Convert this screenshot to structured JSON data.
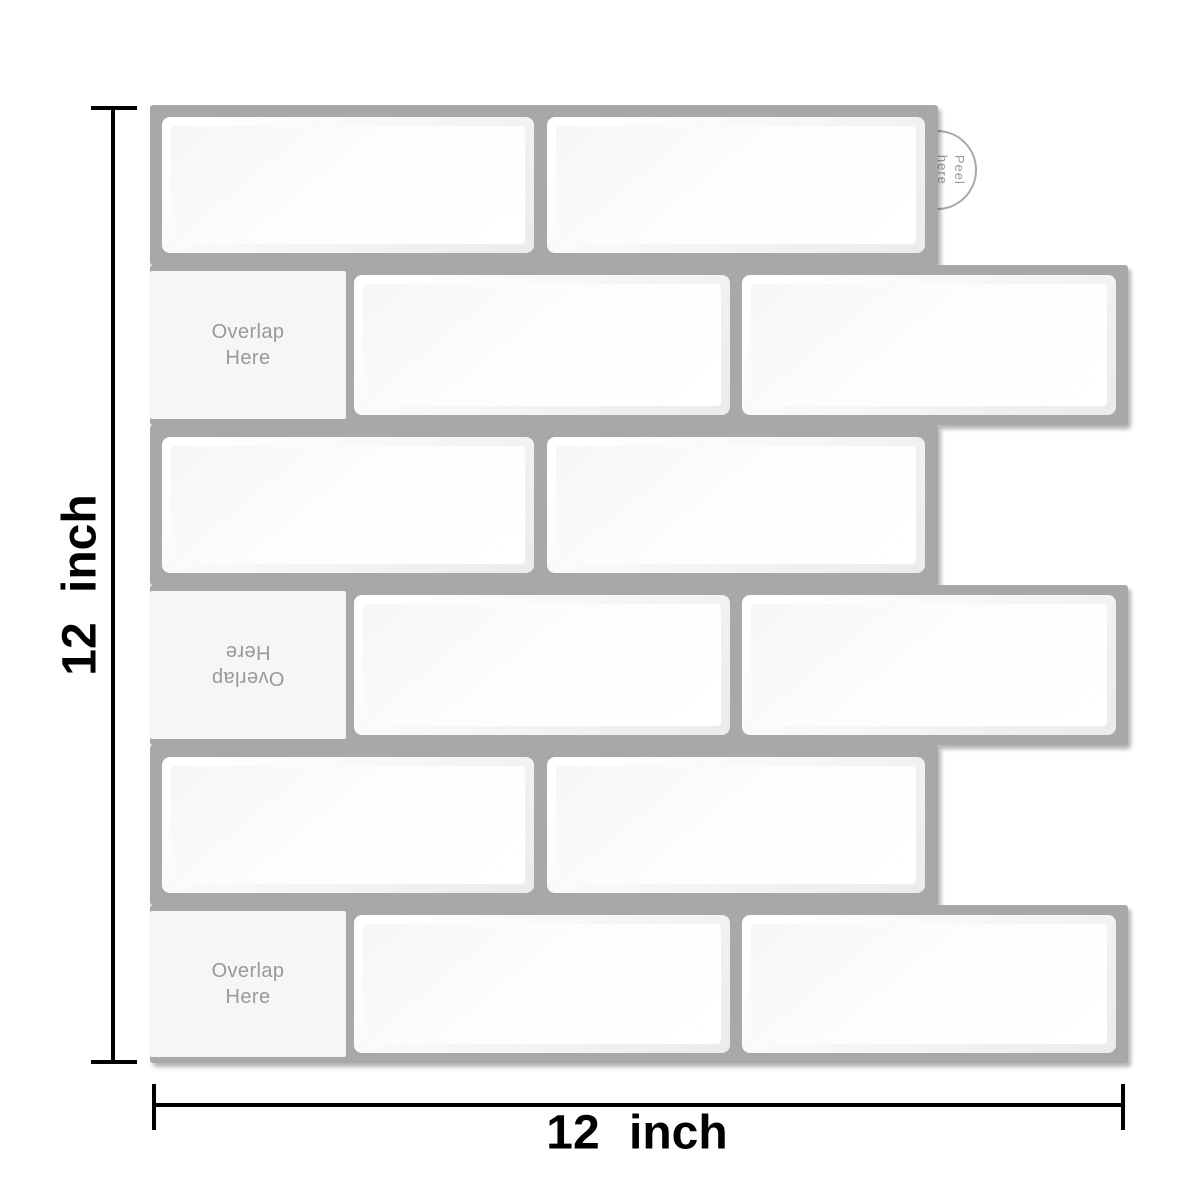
{
  "labels": {
    "left_dimension": "12 inch",
    "bottom_dimension": "12 inch",
    "peel_tab": "Peel here"
  },
  "sheet": {
    "grout_color": "#a8a8a8",
    "tile_color": "#fdfdfd",
    "overlap_flap_color": "#f6f6f6",
    "text_gray": "#999999",
    "rows": [
      {
        "position": 1,
        "type": "two-tile",
        "peel_tab_label": "Peel here"
      },
      {
        "position": 2,
        "type": "overlap-plus-two-tile",
        "overlap_label": "Overlap Here",
        "overlap_text_rotation_deg": 0
      },
      {
        "position": 3,
        "type": "two-tile"
      },
      {
        "position": 4,
        "type": "overlap-plus-two-tile",
        "overlap_label": "Overlap Here",
        "overlap_text_rotation_deg": 180
      },
      {
        "position": 5,
        "type": "two-tile"
      },
      {
        "position": 6,
        "type": "overlap-plus-two-tile",
        "overlap_label": "Overlap Here",
        "overlap_text_rotation_deg": 0
      }
    ]
  },
  "dimension_line_color": "#000000"
}
